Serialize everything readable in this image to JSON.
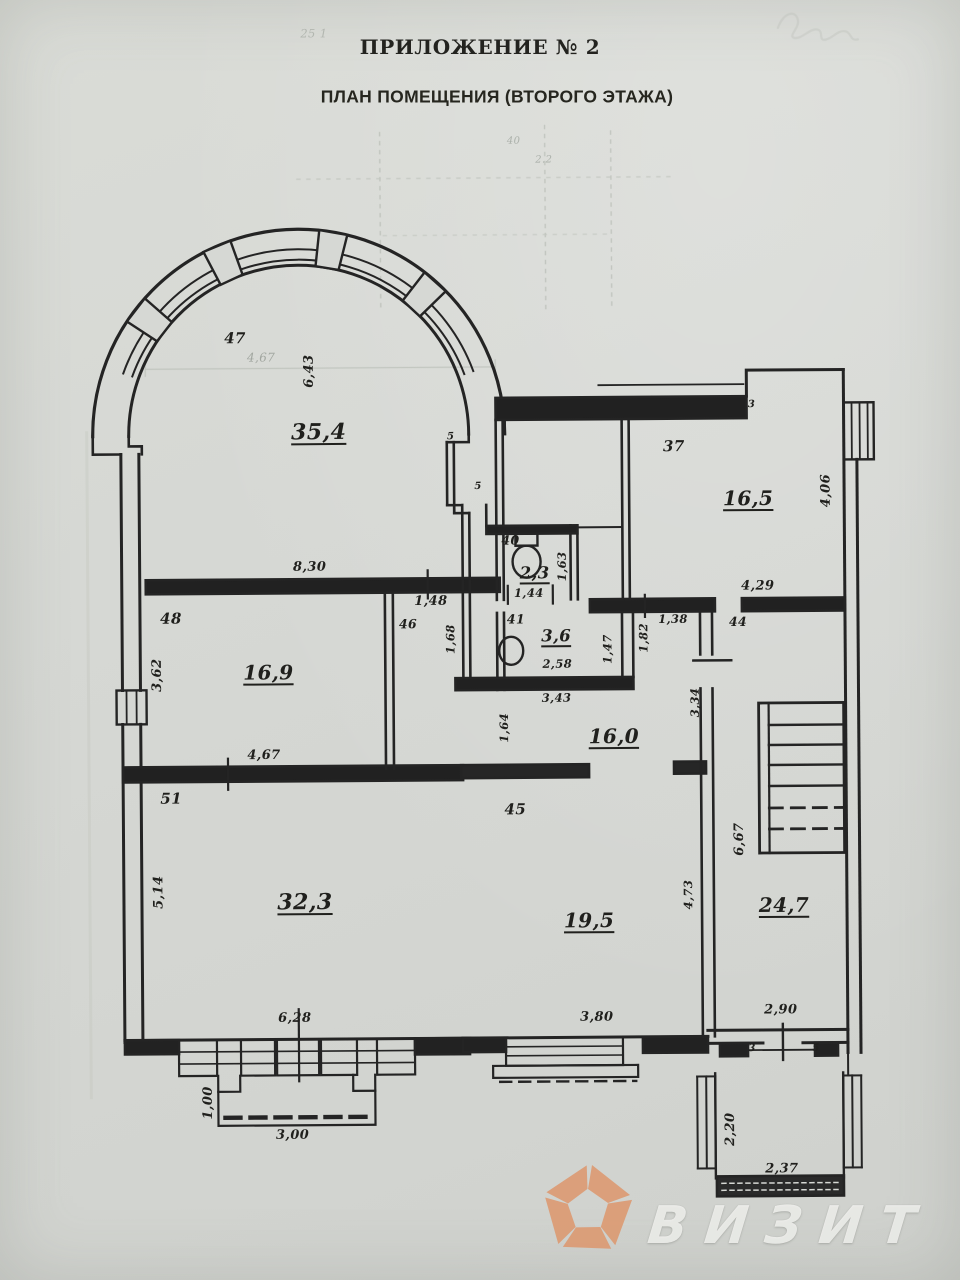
{
  "document": {
    "title": "ПРИЛОЖЕНИЕ № 2",
    "subtitle": "ПЛАН ПОМЕЩЕНИЯ (ВТОРОГО ЭТАЖА)"
  },
  "plan": {
    "rooms": {
      "rotunda": {
        "number": "47",
        "area": "35,4"
      },
      "room37": {
        "number": "37",
        "area": "16,5"
      },
      "wc40": {
        "number": "40",
        "area": "2,3"
      },
      "wc41": {
        "number": "41",
        "area": "3,6"
      },
      "hall46": {
        "number": "46"
      },
      "room48": {
        "number": "48",
        "area": "16,9"
      },
      "corridor": {
        "area": "16,0"
      },
      "hall44": {
        "number": "44"
      },
      "room45": {
        "number": "45",
        "area": "19,5"
      },
      "room51": {
        "number": "51",
        "area": "32,3"
      },
      "stairwell": {
        "area": "24,7"
      }
    },
    "dimensions": {
      "rotunda_height": "6,43",
      "rotunda_width_faint": "4,67",
      "room37_height": "4,06",
      "room37_width": "4,29",
      "wc40_width": "1,44",
      "wc40_height": "1,63",
      "wc41_width": "2,58",
      "wc41_width_outer": "3,43",
      "wc41_height": "1,47",
      "hall46_width": "1,48",
      "hall46_height": "1,68",
      "room48_top_width": "8,30",
      "room48_height": "3,62",
      "room48_width": "4,67",
      "corridor_height": "1,64",
      "corridor_d1": "1,38",
      "corridor_d2": "1,82",
      "corridor_d3": "3,34",
      "room45_width": "3,80",
      "room45_height": "4,73",
      "room51_height": "5,14",
      "room51_width": "6,28",
      "stair_height": "6,67",
      "stair_width": "2,90",
      "balcony_left_height": "1,00",
      "balcony_left_width": "3,00",
      "balcony_right_height": "2,20",
      "balcony_right_width": "2,37",
      "step_a": "5",
      "step_b": "5",
      "step_c": "3",
      "step_d": "3",
      "step_e": "5"
    },
    "artifacts": {
      "pencil_top": "25 1",
      "bleed_a": "40",
      "bleed_b": "2.2"
    }
  },
  "watermark": {
    "text": "ВИЗИТ",
    "accent_color": "#dc9a72"
  }
}
